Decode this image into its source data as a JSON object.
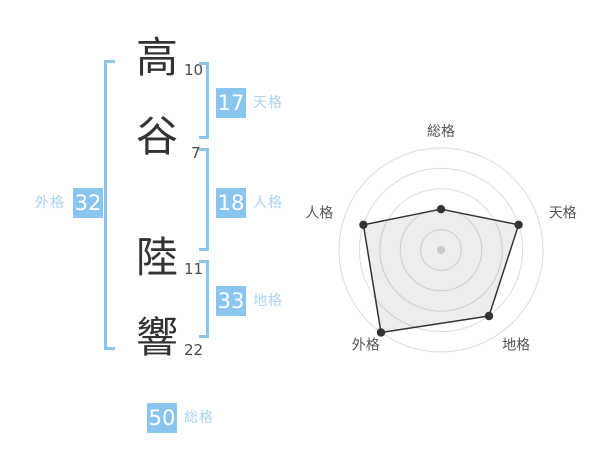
{
  "name": {
    "characters": [
      {
        "char": "高",
        "strokes": "10"
      },
      {
        "char": "谷",
        "strokes": "7"
      },
      {
        "char": "陸",
        "strokes": "11"
      },
      {
        "char": "響",
        "strokes": "22"
      }
    ]
  },
  "kaku": {
    "tenkaku": {
      "label": "天格",
      "value": "17"
    },
    "jinkaku": {
      "label": "人格",
      "value": "18"
    },
    "chikaku": {
      "label": "地格",
      "value": "33"
    },
    "gaikaku": {
      "label": "外格",
      "value": "32"
    },
    "soukaku": {
      "label": "総格",
      "value": "50"
    }
  },
  "colors": {
    "accent_blue": "#8ac5ef",
    "accent_blue_light": "#a9d3f1",
    "box_text": "#ffffff",
    "name_text": "#333333",
    "stroke_count_text": "#4a4a4a",
    "radar_grid": "#dcdcdc",
    "radar_line": "#333333",
    "radar_fill": "rgba(0,0,0,0.07)",
    "radar_point": "#333333",
    "radar_center_dot": "#c9c9c9",
    "radar_label_text": "#555555"
  },
  "chart_data": {
    "type": "radar",
    "axes": [
      "総格",
      "天格",
      "地格",
      "外格",
      "人格"
    ],
    "values": [
      40,
      80,
      80,
      100,
      80
    ],
    "scale_min": 0,
    "scale_max": 100,
    "rings": [
      20,
      40,
      60,
      80,
      100
    ],
    "start_angle_deg": 90,
    "direction": "clockwise",
    "grid_shape": "circle",
    "legend": "none",
    "title": ""
  }
}
